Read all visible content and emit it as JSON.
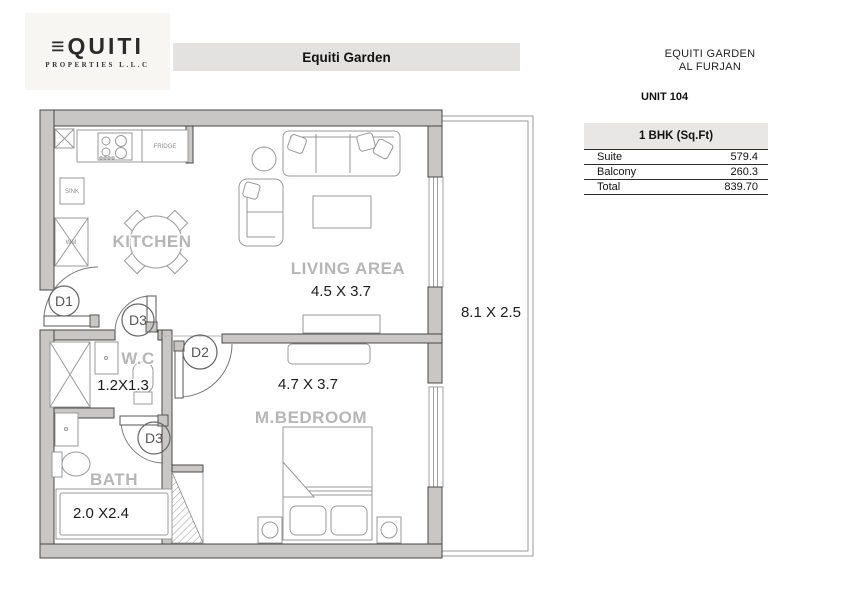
{
  "header": {
    "logo_brand": "≡QUITI",
    "logo_sub": "PROPERTIES L.L.C",
    "title": "Equiti Garden",
    "project_line1": "EQUITI GARDEN",
    "project_line2": "AL FURJAN",
    "unit_label": "UNIT 104"
  },
  "area_table": {
    "header": "1 BHK (Sq.Ft)",
    "rows": [
      {
        "label": "Suite",
        "value": "579.4"
      },
      {
        "label": "Balcony",
        "value": "260.3"
      },
      {
        "label": "Total",
        "value": "839.70"
      }
    ]
  },
  "floor_plan": {
    "rooms": {
      "kitchen": {
        "name": "KITCHEN"
      },
      "living": {
        "name": "LIVING AREA",
        "dim": "4.5 X 3.7"
      },
      "bedroom": {
        "name": "M.BEDROOM",
        "dim": "4.7 X 3.7"
      },
      "wc": {
        "name": "W.C",
        "dim": "1.2X1.3"
      },
      "bath": {
        "name": "BATH",
        "dim": "2.0 X2.4"
      },
      "balcony": {
        "dim": "8.1 X 2.5"
      }
    },
    "doors": {
      "d1": "D1",
      "d2": "D2",
      "d3_wc": "D3",
      "d3_bath": "D3"
    },
    "fixtures": {
      "sink": "SINK",
      "wm": "WM",
      "fridge": "FRIDGE"
    }
  },
  "colors": {
    "wall_fill": "#c8c7c5",
    "room_label": "#b6b6b6",
    "header_bar": "#e4e2e0",
    "table_header_bg": "#e9e7e5"
  }
}
